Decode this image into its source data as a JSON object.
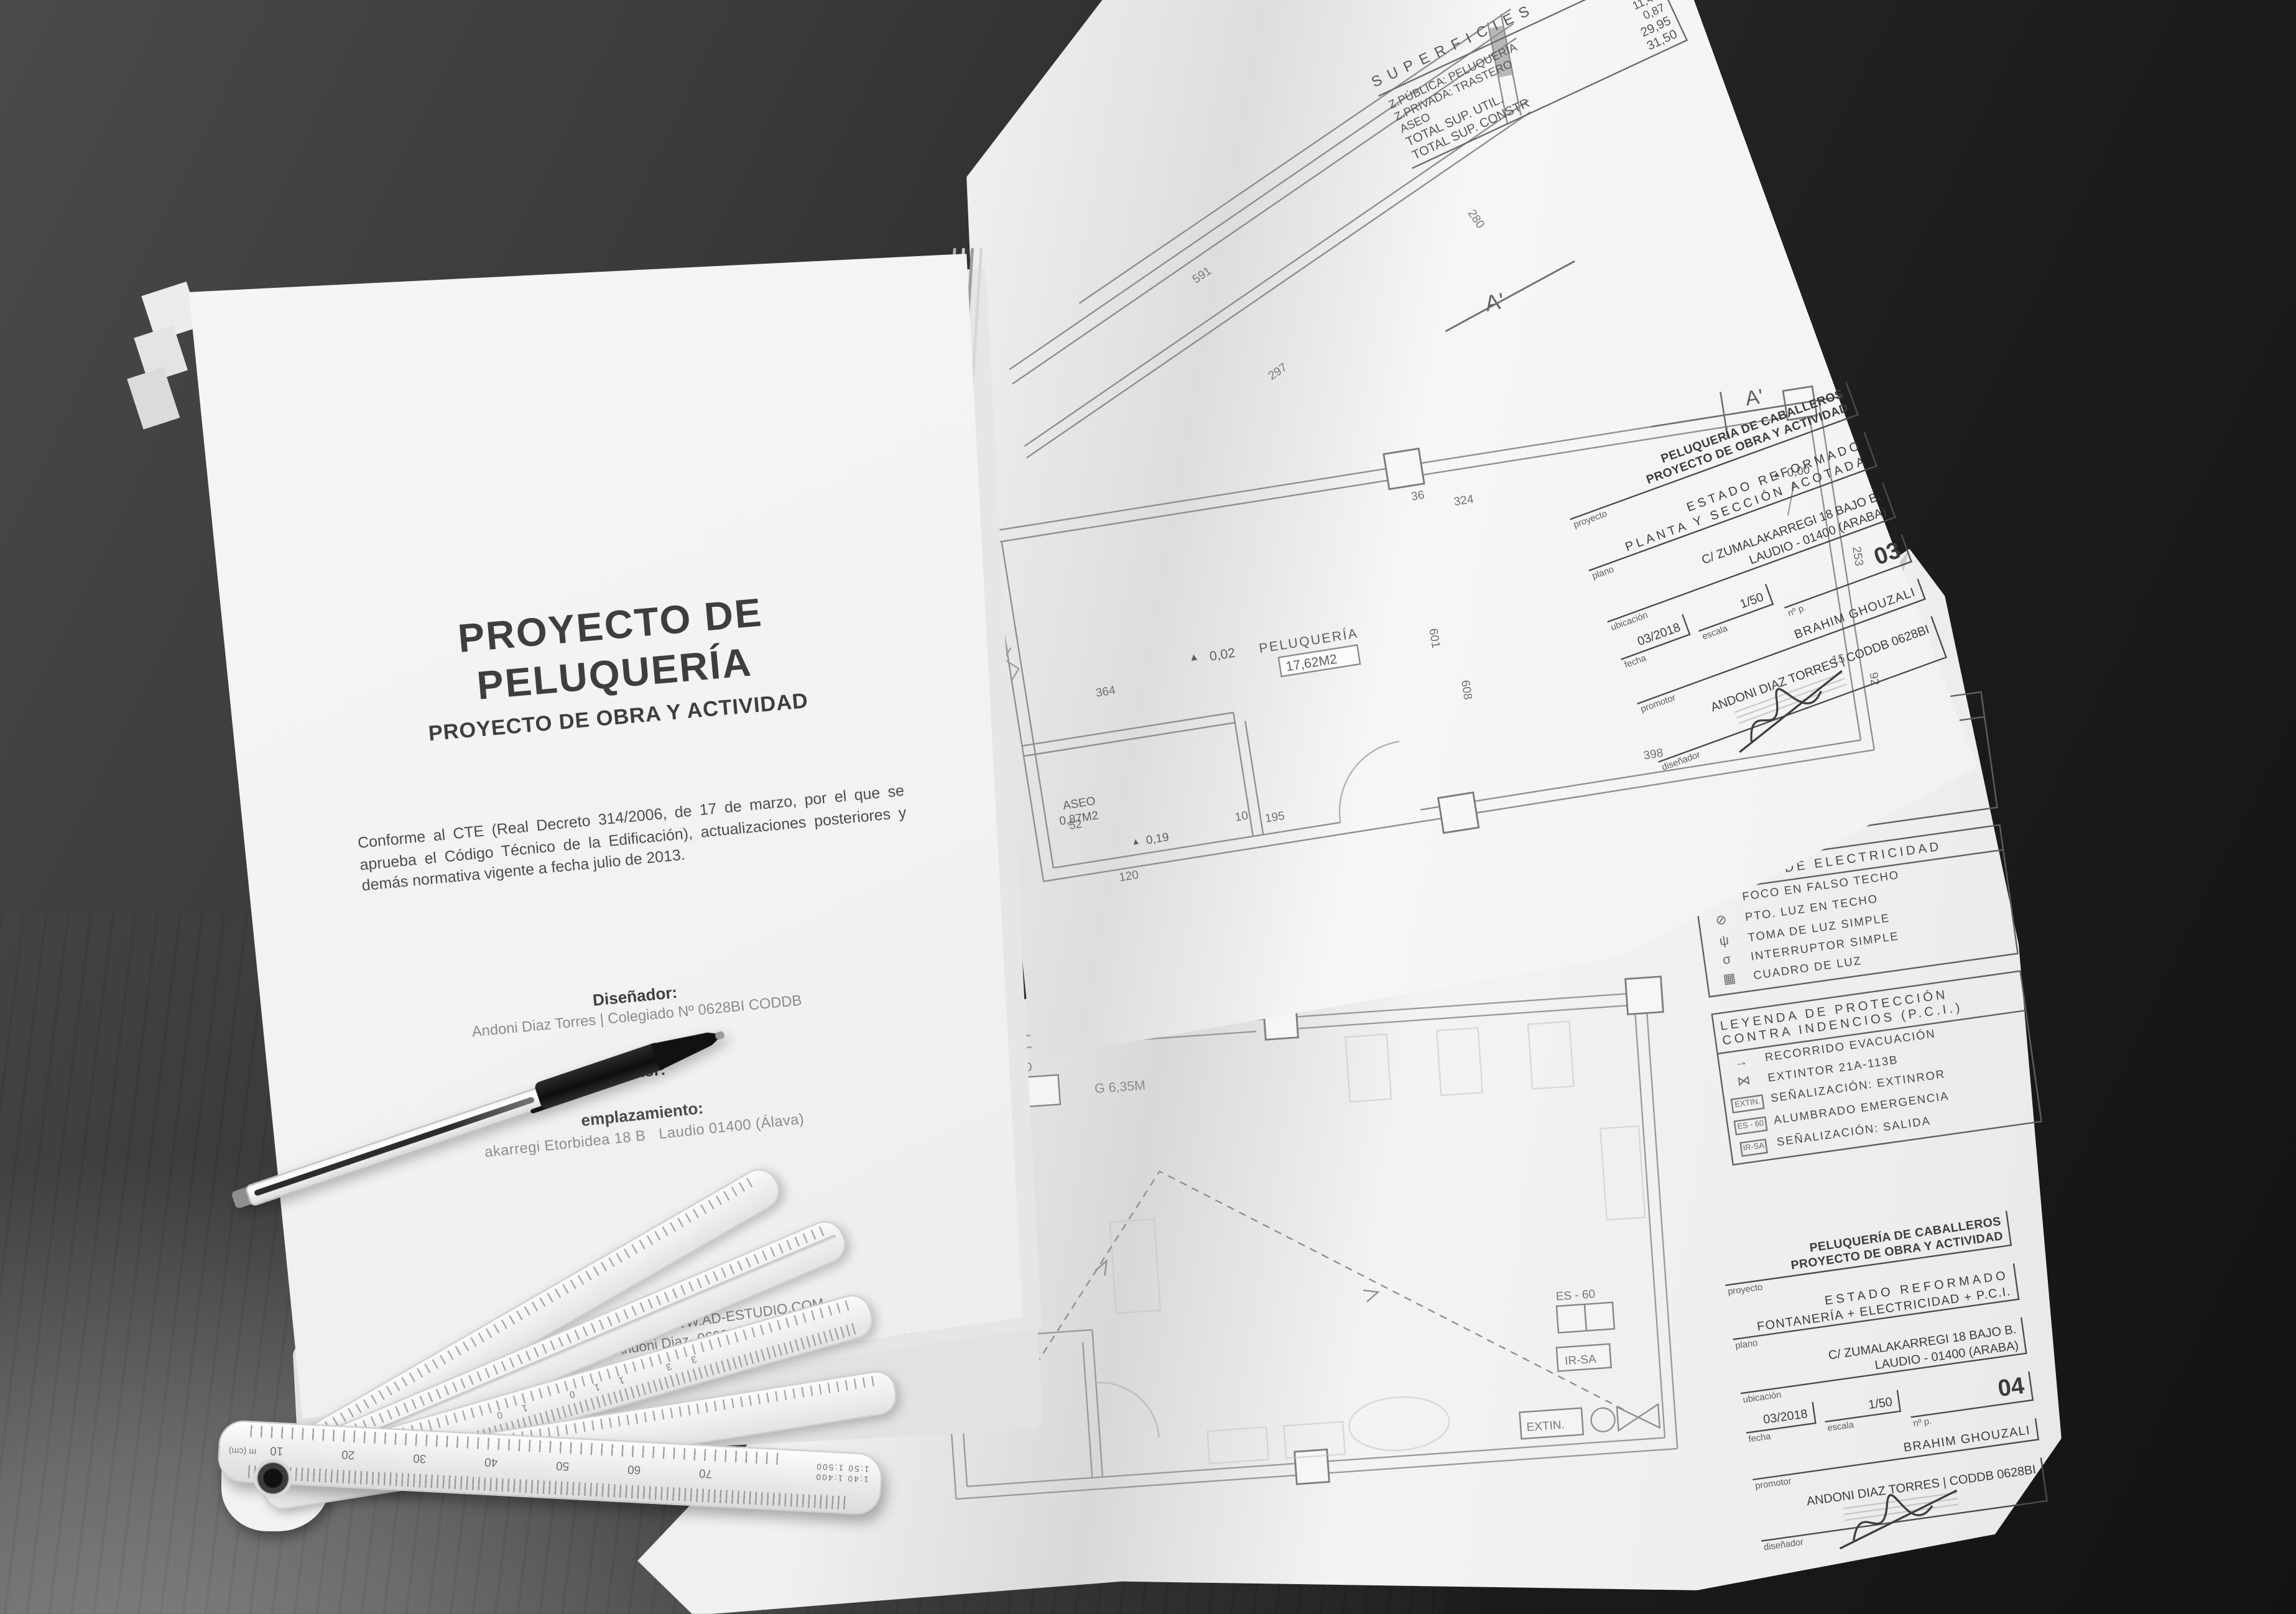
{
  "appearance": {
    "desk_dark": "#1b1b1d",
    "desk_light_corner": "#7a7a7c",
    "paper_white": "#f2f2f2",
    "ink_gray": "#3e3e3e"
  },
  "cover": {
    "title_line1": "PROYECTO DE",
    "title_line2": "PELUQUERÍA",
    "subtitle": "PROYECTO DE OBRA Y ACTIVIDAD",
    "body_paragraph": "Conforme al CTE (Real Decreto 314/2006, de 17 de marzo, por el que se aprueba el Código Técnico de la Edificación), actualizaciones posteriores y demás normativa vigente a fecha julio de 2013.",
    "designer_label": "Diseñador:",
    "designer_value": "Andoni Diaz Torres | Colegiado Nº 0628BI CODDB",
    "promoter_label": "Promotor:",
    "location_label": "emplazamiento:",
    "location_fragment1": "akarregi Etorbidea 18 B",
    "location_fragment2": "Laudio 01400 (Álava)",
    "footer_line1": "R DESIGN | WWW.AD-ESTUDIO.COM",
    "footer_line2": "Andoni Diaz- 0628BI CODDB"
  },
  "superficies": {
    "title": "SUPERFICIES",
    "rows": [
      {
        "label": "Z.PÚBLICA: PELUQUERÍA",
        "value": "17,62"
      },
      {
        "label": "Z.PRIVADA: TRASTERO",
        "value": "11,46"
      },
      {
        "label": "ASEO",
        "value": "0,87"
      },
      {
        "label": "TOTAL SUP. UTIL.",
        "value": "29,95"
      },
      {
        "label": "TOTAL SUP. CONSTR",
        "value": "31,50"
      }
    ]
  },
  "plan03": {
    "section_label": "A'",
    "plan_label": "A'",
    "level_zero": "0,00",
    "level_room": "0,02",
    "level_aseo": "0,19",
    "room1_name": "PELUQUERÍA",
    "room1_area": "17,62M2",
    "room2_name": "ASEO",
    "room2_area": "0,87M2",
    "dims": [
      "364",
      "324",
      "253",
      "601",
      "608",
      "398",
      "195",
      "52",
      "120",
      "10",
      "36",
      "92",
      "15"
    ],
    "section_dims": [
      "591",
      "297",
      "280"
    ]
  },
  "titleblock03": {
    "project_line1": "PELUQUERÍA DE CABALLEROS",
    "project_line2": "PROYECTO DE OBRA Y ACTIVIDAD",
    "project_label": "proyecto",
    "plan_line1": "ESTADO REFORMADO",
    "plan_line2": "PLANTA Y SECCIÓN ACOTADA",
    "plan_label": "plano",
    "location_line1": "C/ ZUMALAKARREGI 18 BAJO B.",
    "location_line2": "LAUDIO - 01400 (ARABA)",
    "location_label": "ubicación",
    "date_label": "fecha",
    "date_value": "03/2018",
    "scale_label": "escala",
    "scale_value": "1/50",
    "number_label": "nº p.",
    "number_value": "03",
    "promoter_label": "promotor",
    "promoter_value": "BRAHIM GHOUZALI",
    "designer_label": "diseñador",
    "designer_value": "ANDONI DIAZ TORRES | CODDB 0628BI"
  },
  "legends": {
    "fontaneria": {
      "title": "LEYENDA DE FONTANERÍA",
      "rows": [
        {
          "sym": "◉",
          "label": "TOMA AGUA CALIENTE"
        },
        {
          "sym": "◎",
          "label": "TOMA AGUA FRÍA"
        },
        {
          "sym": "⊖",
          "label": "DESAGÜE"
        },
        {
          "sym": "Ⓒ",
          "label": "CALENTADOR ELÉCTRICO"
        }
      ]
    },
    "electricidad": {
      "title": "LEYENDA DE ELECTRICIDAD",
      "rows": [
        {
          "sym": "⊗",
          "label": "FOCO EN FALSO TECHO"
        },
        {
          "sym": "⊘",
          "label": "PTO. LUZ EN TECHO"
        },
        {
          "sym": "ψ",
          "label": "TOMA DE LUZ SIMPLE"
        },
        {
          "sym": "σ",
          "label": "INTERRUPTOR SIMPLE"
        },
        {
          "sym": "▦",
          "label": "CUADRO DE LUZ"
        }
      ]
    },
    "pci": {
      "title_line1": "LEYENDA DE PROTECCIÓN",
      "title_line2": "CONTRA INDENCIOS (P.C.I.)",
      "rows": [
        {
          "sym": "→",
          "label": "RECORRIDO EVACUACIÓN"
        },
        {
          "sym": "⋈",
          "label": "EXTINTOR 21A-113B"
        },
        {
          "sym": "EXTIN.",
          "boxed": true,
          "label": "SEÑALIZACIÓN: EXTINROR"
        },
        {
          "sym": "ES - 60",
          "boxed": true,
          "label": "ALUMBRADO EMERGENCIA"
        },
        {
          "sym": "IR-SA",
          "boxed": true,
          "label": "SEÑALIZACIÓN: SALIDA"
        }
      ]
    }
  },
  "titleblock04": {
    "project_line1": "PELUQUERÍA DE CABALLEROS",
    "project_line2": "PROYECTO DE OBRA Y ACTIVIDAD",
    "project_label": "proyecto",
    "plan_line1": "ESTADO REFORMADO",
    "plan_line2": "FONTANERÍA + ELECTRICIDAD + P.C.I.",
    "plan_label": "plano",
    "location_line1": "C/ ZUMALAKARREGI 18 BAJO B.",
    "location_line2": "LAUDIO - 01400 (ARABA)",
    "location_label": "ubicación",
    "date_label": "fecha",
    "date_value": "03/2018",
    "scale_label": "escala",
    "scale_value": "1/50",
    "number_label": "nº p.",
    "number_value": "04",
    "promoter_label": "promotor",
    "promoter_value": "BRAHIM GHOUZALI",
    "designer_label": "diseñador",
    "designer_value": "ANDONI DIAZ TORRES | CODDB 0628BI"
  },
  "plan04": {
    "es60_box_a": "ES - 60",
    "es60_box_b": "ES - 60",
    "irsa_box": "IR-SA",
    "extin_box": "EXTIN.",
    "dist_a": "G 6,35M",
    "dist_b": "G 9,75M"
  },
  "rulers": {
    "front_numbers": [
      "70",
      "60",
      "50",
      "40",
      "30",
      "20",
      "10"
    ],
    "front_unit": "m (cm)",
    "front_scales": [
      "1:40",
      "1:400",
      "1:50",
      "1:500"
    ],
    "arm_numbers": [
      "33",
      "110",
      "10"
    ]
  }
}
